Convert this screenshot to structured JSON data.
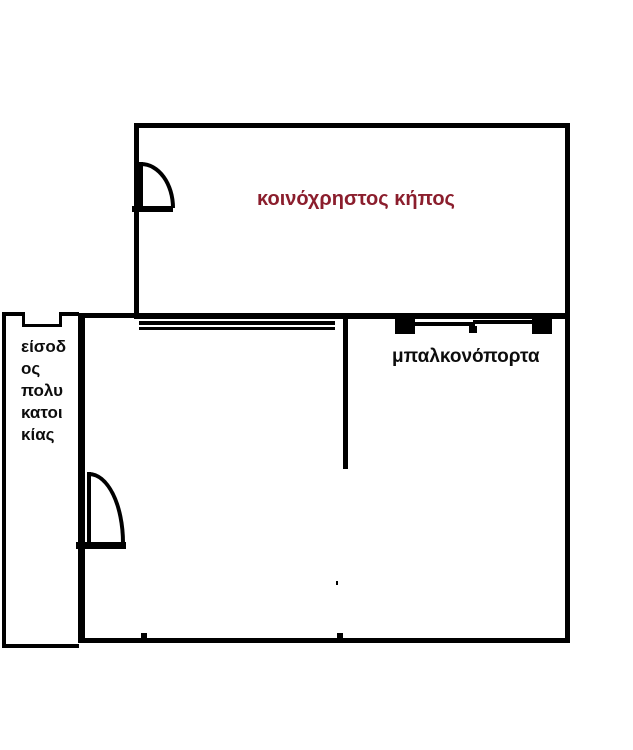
{
  "page": {
    "type": "floor-plan-sketch",
    "background": "#ffffff"
  },
  "colors": {
    "wall": "#000000",
    "garden_label_color": "#8b1e2d",
    "label_color": "#0d0d0d"
  },
  "garden": {
    "label": "κοινόχρηστος κήπος"
  },
  "apartment": {
    "balcony_door_label": "μπαλκονόπορτα"
  },
  "entrance": {
    "label": "είσοδ\nος\nπολυ\nκατοι\nκίας"
  },
  "icons": {
    "garden_door": "door-swing-icon",
    "apartment_door": "door-swing-icon",
    "balcony_door": "sliding-door-icon",
    "entrance_door": "door-opening-notch"
  }
}
